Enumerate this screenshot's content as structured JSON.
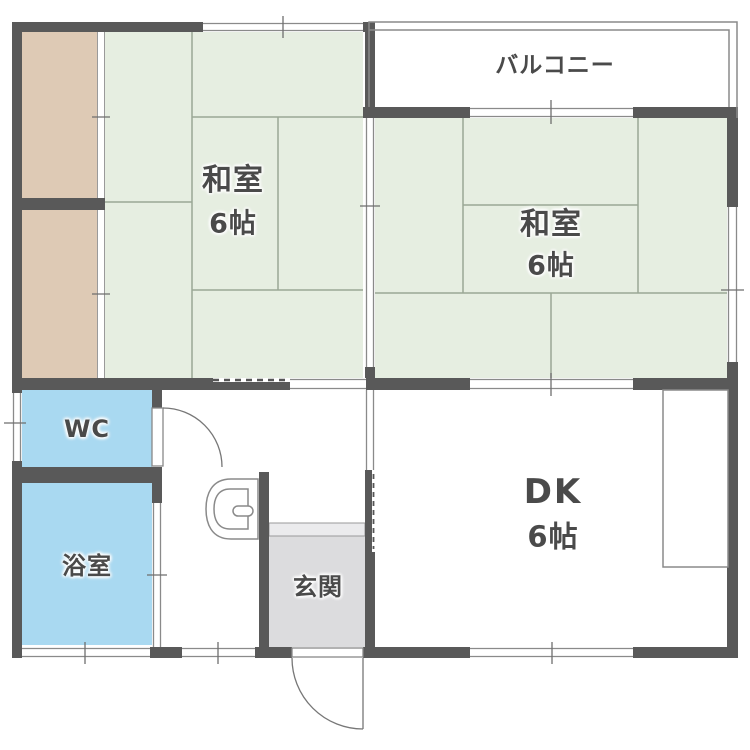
{
  "floorplan": {
    "title": "1DK apartment floor plan",
    "rooms": {
      "balcony": {
        "label": "バルコニー"
      },
      "washitsu_left": {
        "label": "和室",
        "size": "6帖"
      },
      "washitsu_right": {
        "label": "和室",
        "size": "6帖"
      },
      "wc": {
        "label": "WC"
      },
      "bath": {
        "label": "浴室"
      },
      "genkan": {
        "label": "玄関"
      },
      "dk": {
        "label": "DK",
        "size": "6帖"
      }
    },
    "colors": {
      "wall": "#595959",
      "tatami_fill": "#e6eee1",
      "closet_fill": "#decab5",
      "wet_area_fill": "#a9d9f1",
      "entrance_fill": "#dcdcde",
      "line": "#8a8a8a"
    },
    "fixtures": [
      "toilet",
      "kitchen-counter",
      "wc-swing-door",
      "entrance-swing-door",
      "bath-sliding-door",
      "balcony-railing"
    ]
  }
}
